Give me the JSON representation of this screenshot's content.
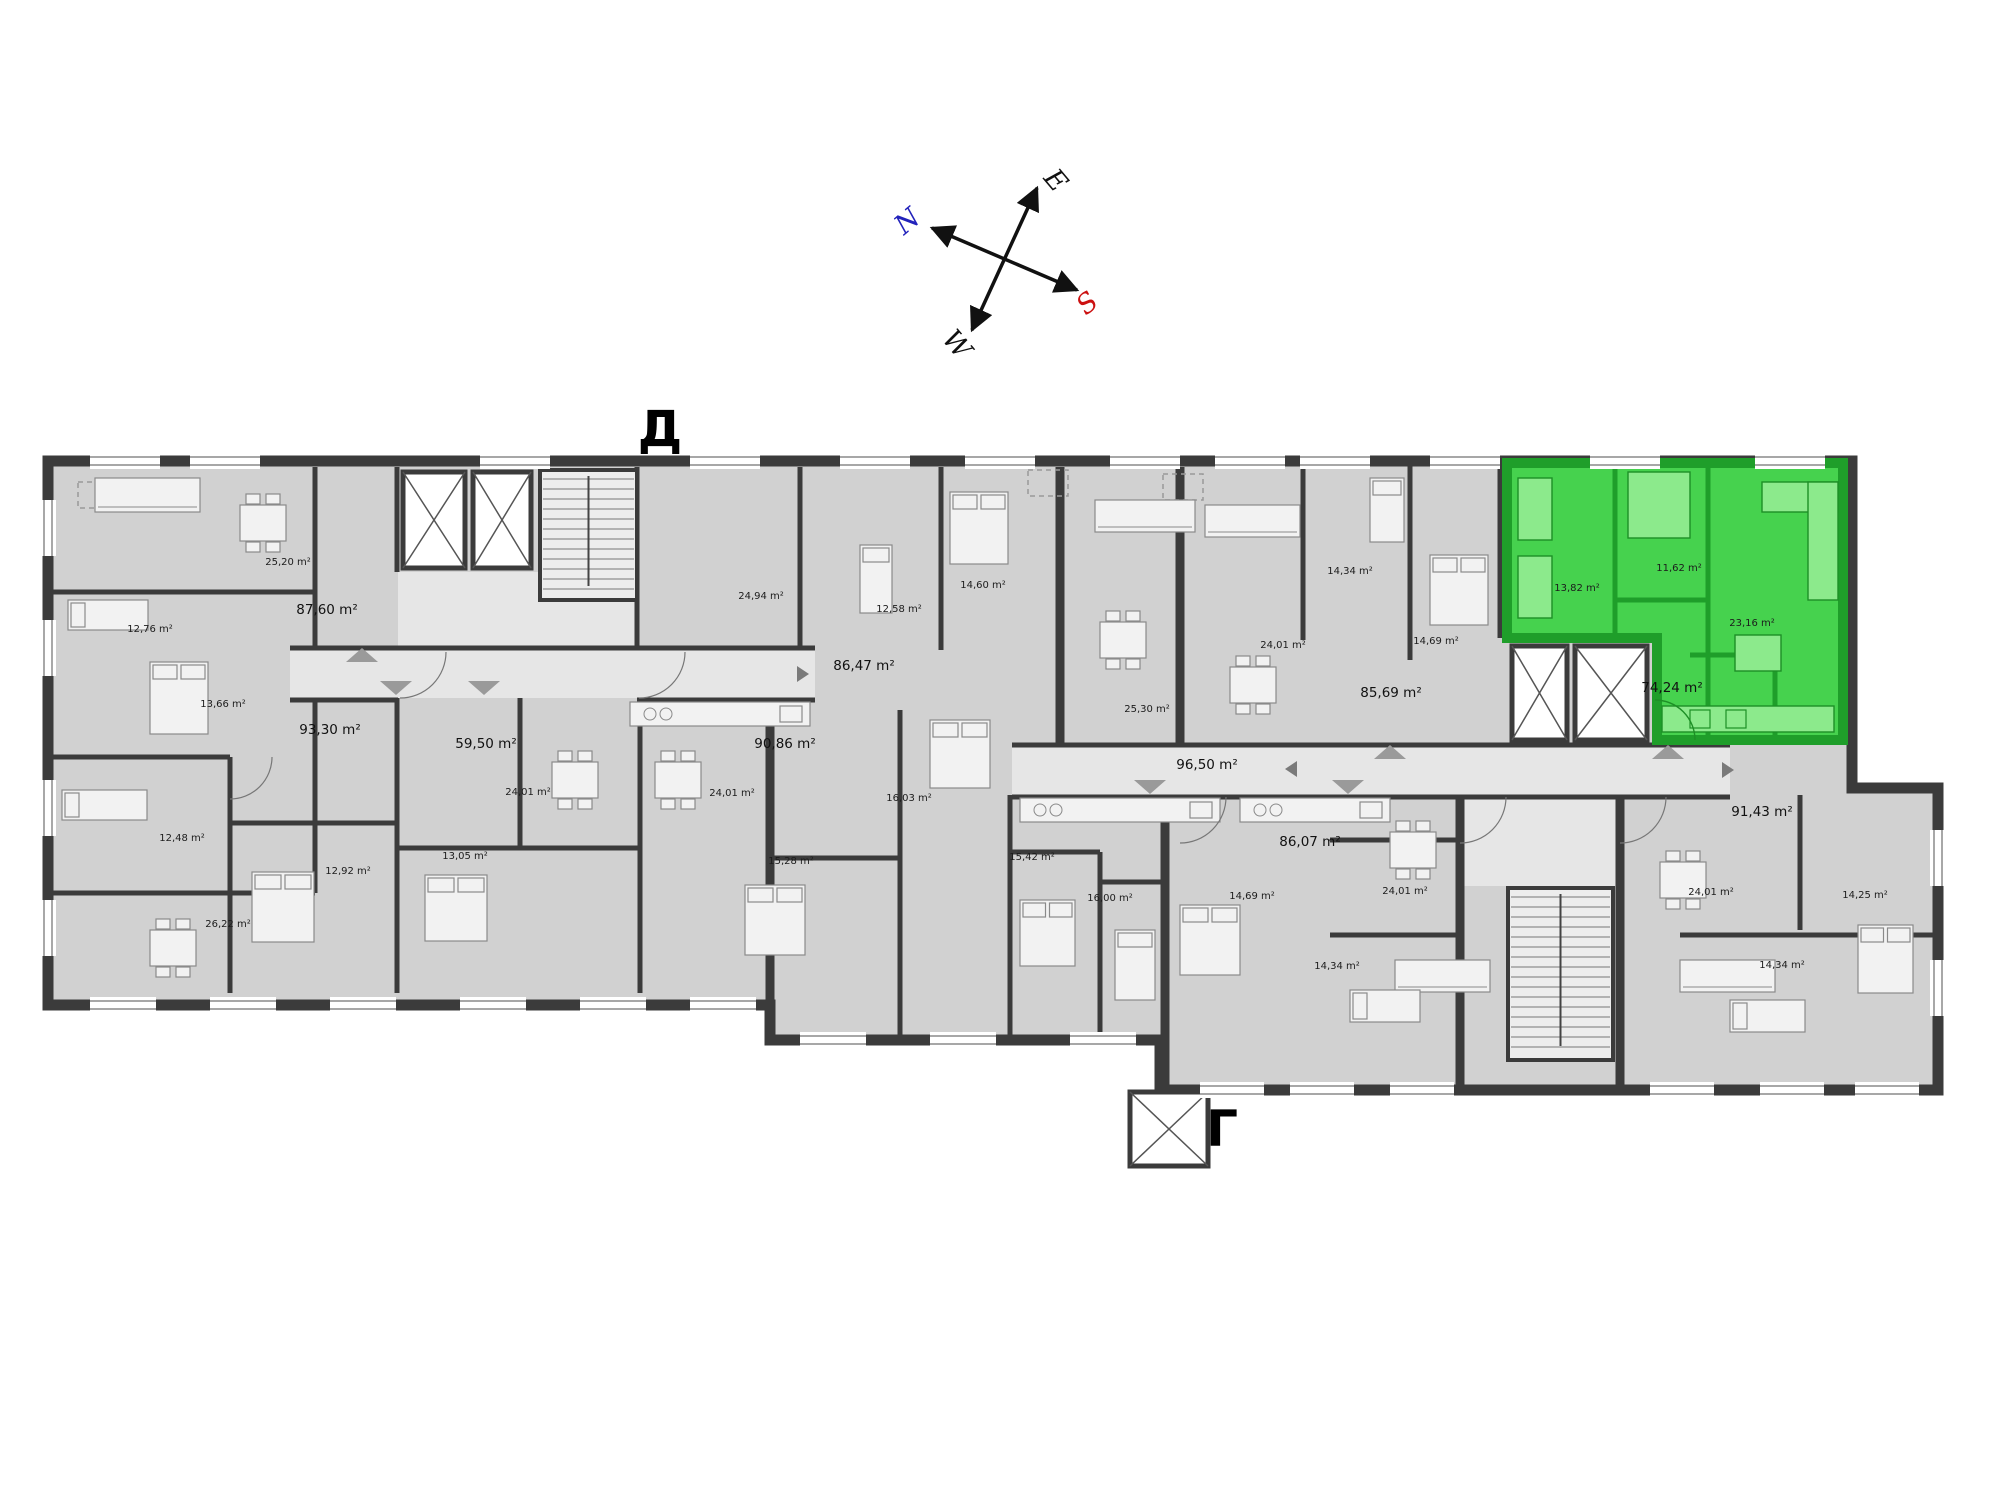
{
  "plan_title": "Apartment floor plan",
  "building_labels": [
    {
      "label": "Д",
      "x": 660,
      "y": 446
    },
    {
      "label": "Г",
      "x": 1222,
      "y": 1146
    }
  ],
  "compass": {
    "letters": [
      {
        "label": "N",
        "color": "#2222bb",
        "x": 913,
        "y": 228,
        "rotate": -40
      },
      {
        "label": "E",
        "color": "#111111",
        "x": 1049,
        "y": 186,
        "rotate": 50
      },
      {
        "label": "S",
        "color": "#cc1111",
        "x": 1093,
        "y": 310,
        "rotate": -40
      },
      {
        "label": "W",
        "color": "#111111",
        "x": 950,
        "y": 350,
        "rotate": 50
      }
    ]
  },
  "highlighted_unit": {
    "name": "green-apartment",
    "total_area": "74,24 m²",
    "fill_color": "#46d24e",
    "wall_color": "#1f9e2a"
  },
  "area_labels": [
    {
      "text": "25,20 m²",
      "x": 288,
      "y": 565
    },
    {
      "text": "87,60 m²",
      "x": 327,
      "y": 614,
      "big": true
    },
    {
      "text": "12,76 m²",
      "x": 150,
      "y": 632
    },
    {
      "text": "13,66 m²",
      "x": 223,
      "y": 707
    },
    {
      "text": "93,30 m²",
      "x": 330,
      "y": 734,
      "big": true
    },
    {
      "text": "12,48 m²",
      "x": 182,
      "y": 841
    },
    {
      "text": "12,92 m²",
      "x": 348,
      "y": 874
    },
    {
      "text": "26,22 m²",
      "x": 228,
      "y": 927
    },
    {
      "text": "59,50 m²",
      "x": 486,
      "y": 748,
      "big": true
    },
    {
      "text": "24,01 m²",
      "x": 528,
      "y": 795
    },
    {
      "text": "13,05 m²",
      "x": 465,
      "y": 859
    },
    {
      "text": "24,01 m²",
      "x": 732,
      "y": 796
    },
    {
      "text": "24,94 m²",
      "x": 761,
      "y": 599
    },
    {
      "text": "86,47 m²",
      "x": 864,
      "y": 670,
      "big": true
    },
    {
      "text": "90,86 m²",
      "x": 785,
      "y": 748,
      "big": true
    },
    {
      "text": "12,58 m²",
      "x": 899,
      "y": 612
    },
    {
      "text": "14,60 m²",
      "x": 983,
      "y": 588
    },
    {
      "text": "16,03 m²",
      "x": 909,
      "y": 801
    },
    {
      "text": "15,28 m²",
      "x": 791,
      "y": 864
    },
    {
      "text": "15,42 m²",
      "x": 1032,
      "y": 860
    },
    {
      "text": "25,30 m²",
      "x": 1147,
      "y": 712
    },
    {
      "text": "16,00 m²",
      "x": 1110,
      "y": 901
    },
    {
      "text": "96,50 m²",
      "x": 1207,
      "y": 769,
      "big": true
    },
    {
      "text": "14,34 m²",
      "x": 1350,
      "y": 574
    },
    {
      "text": "24,01 m²",
      "x": 1283,
      "y": 648
    },
    {
      "text": "14,69 m²",
      "x": 1436,
      "y": 644
    },
    {
      "text": "85,69 m²",
      "x": 1391,
      "y": 697,
      "big": true
    },
    {
      "text": "86,07 m²",
      "x": 1310,
      "y": 846,
      "big": true
    },
    {
      "text": "14,69 m²",
      "x": 1252,
      "y": 899
    },
    {
      "text": "24,01 m²",
      "x": 1405,
      "y": 894
    },
    {
      "text": "14,34 m²",
      "x": 1337,
      "y": 969
    },
    {
      "text": "91,43 m²",
      "x": 1762,
      "y": 816,
      "big": true
    },
    {
      "text": "24,01 m²",
      "x": 1711,
      "y": 895
    },
    {
      "text": "14,25 m²",
      "x": 1865,
      "y": 898
    },
    {
      "text": "14,34 m²",
      "x": 1782,
      "y": 968
    },
    {
      "text": "13,82 m²",
      "x": 1577,
      "y": 591,
      "highlighted": true
    },
    {
      "text": "11,62 m²",
      "x": 1679,
      "y": 571,
      "highlighted": true
    },
    {
      "text": "23,16 m²",
      "x": 1752,
      "y": 626,
      "highlighted": true
    },
    {
      "text": "74,24 m²",
      "x": 1672,
      "y": 692,
      "big": true,
      "highlighted": true
    }
  ]
}
